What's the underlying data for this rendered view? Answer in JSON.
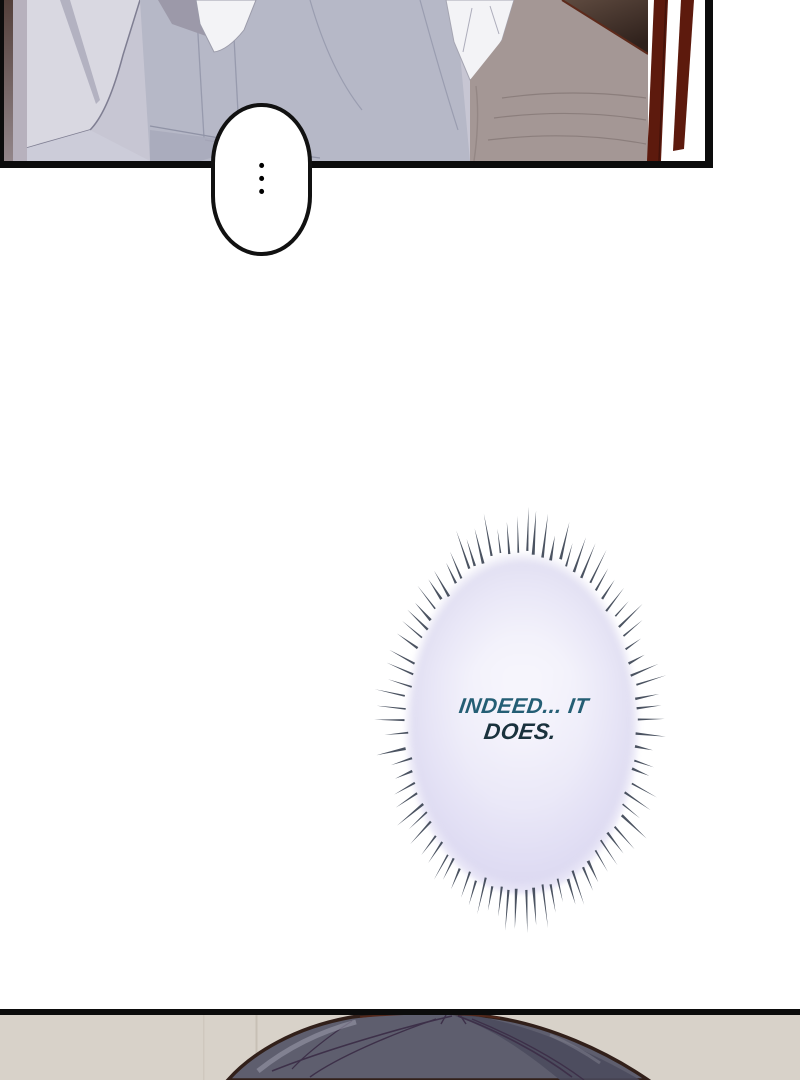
{
  "page": {
    "background": "#ffffff",
    "width": 800,
    "height": 1080
  },
  "panel_top": {
    "border_color": "#0c0c0c",
    "background": "#c7c6d3",
    "door_stripe_color": "#5d1a0d",
    "dark_corner_color": "#32241f"
  },
  "ellipsis_bubble": {
    "fill": "#ffffff",
    "outline": "#111111",
    "dots": [
      "•",
      "•",
      "•"
    ]
  },
  "burst_bubble": {
    "line1": "INDEED... IT",
    "line2": "DOES.",
    "line1_color": "#245e74",
    "line2_color": "#1a323d",
    "fill_tint": "#e3e1f3",
    "ray_color": "#3c4454",
    "ray_count": 86
  },
  "panel_bottom": {
    "border_color": "#0c0c0c",
    "background": "#d8d2c9",
    "hair_color": "#5e5e6e",
    "hair_outline": "#32201a"
  }
}
